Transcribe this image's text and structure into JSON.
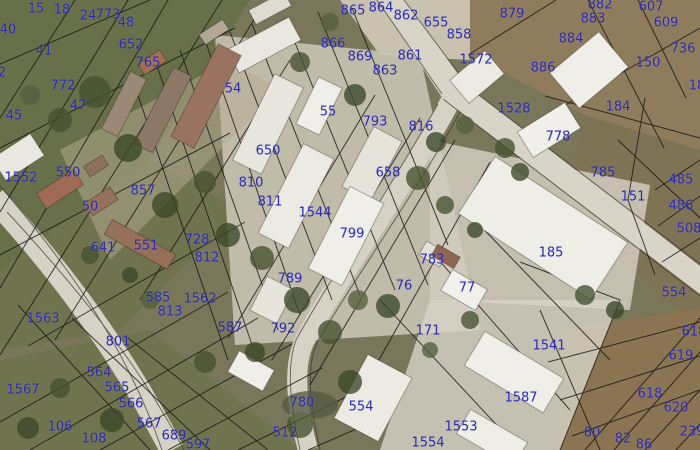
{
  "map": {
    "type": "cadastral-orthophoto",
    "style": {
      "label_color": "#2b2bb4",
      "parcel_line_color": "#151515",
      "road_color": "#d8d4c7",
      "field_green": "#687049",
      "field_dirt": "#8f7c5c",
      "building_white": "#efeee8",
      "building_rust": "#9a7260"
    },
    "parcels": [
      {
        "n": "15",
        "x": 36,
        "y": 9
      },
      {
        "n": "18",
        "x": 62,
        "y": 10
      },
      {
        "n": "24",
        "x": 88,
        "y": 16
      },
      {
        "n": "773",
        "x": 108,
        "y": 15
      },
      {
        "n": "48",
        "x": 126,
        "y": 23
      },
      {
        "n": "40",
        "x": 8,
        "y": 30
      },
      {
        "n": "41",
        "x": 44,
        "y": 51
      },
      {
        "n": "652",
        "x": 131,
        "y": 45
      },
      {
        "n": "765",
        "x": 148,
        "y": 63
      },
      {
        "n": "772",
        "x": 63,
        "y": 86
      },
      {
        "n": "47",
        "x": 78,
        "y": 106
      },
      {
        "n": "45",
        "x": 14,
        "y": 116
      },
      {
        "n": "2",
        "x": 2,
        "y": 73
      },
      {
        "n": "865",
        "x": 353,
        "y": 11
      },
      {
        "n": "864",
        "x": 381,
        "y": 8
      },
      {
        "n": "862",
        "x": 406,
        "y": 16
      },
      {
        "n": "655",
        "x": 436,
        "y": 23
      },
      {
        "n": "858",
        "x": 459,
        "y": 35
      },
      {
        "n": "879",
        "x": 512,
        "y": 14
      },
      {
        "n": "882",
        "x": 600,
        "y": 5
      },
      {
        "n": "883",
        "x": 593,
        "y": 19
      },
      {
        "n": "607",
        "x": 651,
        "y": 7
      },
      {
        "n": "609",
        "x": 666,
        "y": 23
      },
      {
        "n": "884",
        "x": 571,
        "y": 39
      },
      {
        "n": "736",
        "x": 683,
        "y": 49
      },
      {
        "n": "866",
        "x": 333,
        "y": 44
      },
      {
        "n": "869",
        "x": 360,
        "y": 57
      },
      {
        "n": "861",
        "x": 410,
        "y": 56
      },
      {
        "n": "863",
        "x": 385,
        "y": 71
      },
      {
        "n": "1572",
        "x": 476,
        "y": 60
      },
      {
        "n": "886",
        "x": 543,
        "y": 68
      },
      {
        "n": "150",
        "x": 648,
        "y": 63
      },
      {
        "n": "18",
        "x": 697,
        "y": 86
      },
      {
        "n": "54",
        "x": 233,
        "y": 89
      },
      {
        "n": "55",
        "x": 328,
        "y": 112
      },
      {
        "n": "793",
        "x": 375,
        "y": 122
      },
      {
        "n": "816",
        "x": 421,
        "y": 127
      },
      {
        "n": "1528",
        "x": 514,
        "y": 109
      },
      {
        "n": "184",
        "x": 618,
        "y": 107
      },
      {
        "n": "778",
        "x": 558,
        "y": 137
      },
      {
        "n": "1552",
        "x": 21,
        "y": 178
      },
      {
        "n": "550",
        "x": 68,
        "y": 173
      },
      {
        "n": "857",
        "x": 143,
        "y": 191
      },
      {
        "n": "650",
        "x": 268,
        "y": 151
      },
      {
        "n": "658",
        "x": 388,
        "y": 173
      },
      {
        "n": "810",
        "x": 251,
        "y": 183
      },
      {
        "n": "811",
        "x": 270,
        "y": 202
      },
      {
        "n": "50",
        "x": 90,
        "y": 207
      },
      {
        "n": "1544",
        "x": 315,
        "y": 213
      },
      {
        "n": "785",
        "x": 603,
        "y": 173
      },
      {
        "n": "151",
        "x": 633,
        "y": 197
      },
      {
        "n": "485",
        "x": 681,
        "y": 180
      },
      {
        "n": "486",
        "x": 681,
        "y": 206
      },
      {
        "n": "508",
        "x": 689,
        "y": 229
      },
      {
        "n": "799",
        "x": 352,
        "y": 234
      },
      {
        "n": "728",
        "x": 197,
        "y": 240
      },
      {
        "n": "641",
        "x": 103,
        "y": 248
      },
      {
        "n": "551",
        "x": 146,
        "y": 246
      },
      {
        "n": "812",
        "x": 207,
        "y": 258
      },
      {
        "n": "185",
        "x": 551,
        "y": 253
      },
      {
        "n": "783",
        "x": 432,
        "y": 260
      },
      {
        "n": "789",
        "x": 290,
        "y": 279
      },
      {
        "n": "76",
        "x": 404,
        "y": 286
      },
      {
        "n": "77",
        "x": 467,
        "y": 288
      },
      {
        "n": "554",
        "x": 674,
        "y": 293
      },
      {
        "n": "585",
        "x": 158,
        "y": 298
      },
      {
        "n": "1562",
        "x": 200,
        "y": 299
      },
      {
        "n": "813",
        "x": 170,
        "y": 312
      },
      {
        "n": "1563",
        "x": 43,
        "y": 319
      },
      {
        "n": "587",
        "x": 230,
        "y": 328
      },
      {
        "n": "801",
        "x": 118,
        "y": 342
      },
      {
        "n": "792",
        "x": 283,
        "y": 329
      },
      {
        "n": "171",
        "x": 428,
        "y": 331
      },
      {
        "n": "618",
        "x": 694,
        "y": 332
      },
      {
        "n": "619",
        "x": 681,
        "y": 356
      },
      {
        "n": "1541",
        "x": 549,
        "y": 346
      },
      {
        "n": "564",
        "x": 99,
        "y": 373
      },
      {
        "n": "1567",
        "x": 23,
        "y": 390
      },
      {
        "n": "565",
        "x": 117,
        "y": 388
      },
      {
        "n": "566",
        "x": 131,
        "y": 404
      },
      {
        "n": "780",
        "x": 302,
        "y": 403
      },
      {
        "n": "554",
        "x": 361,
        "y": 407
      },
      {
        "n": "1587",
        "x": 521,
        "y": 398
      },
      {
        "n": "618",
        "x": 650,
        "y": 394
      },
      {
        "n": "620",
        "x": 676,
        "y": 408
      },
      {
        "n": "106",
        "x": 60,
        "y": 427
      },
      {
        "n": "567",
        "x": 149,
        "y": 424
      },
      {
        "n": "108",
        "x": 94,
        "y": 439
      },
      {
        "n": "689",
        "x": 174,
        "y": 436
      },
      {
        "n": "597",
        "x": 198,
        "y": 445
      },
      {
        "n": "512",
        "x": 285,
        "y": 433
      },
      {
        "n": "1554",
        "x": 428,
        "y": 443
      },
      {
        "n": "1553",
        "x": 461,
        "y": 427
      },
      {
        "n": "80",
        "x": 592,
        "y": 433
      },
      {
        "n": "82",
        "x": 623,
        "y": 439
      },
      {
        "n": "86",
        "x": 644,
        "y": 445
      },
      {
        "n": "239",
        "x": 692,
        "y": 432
      }
    ]
  }
}
